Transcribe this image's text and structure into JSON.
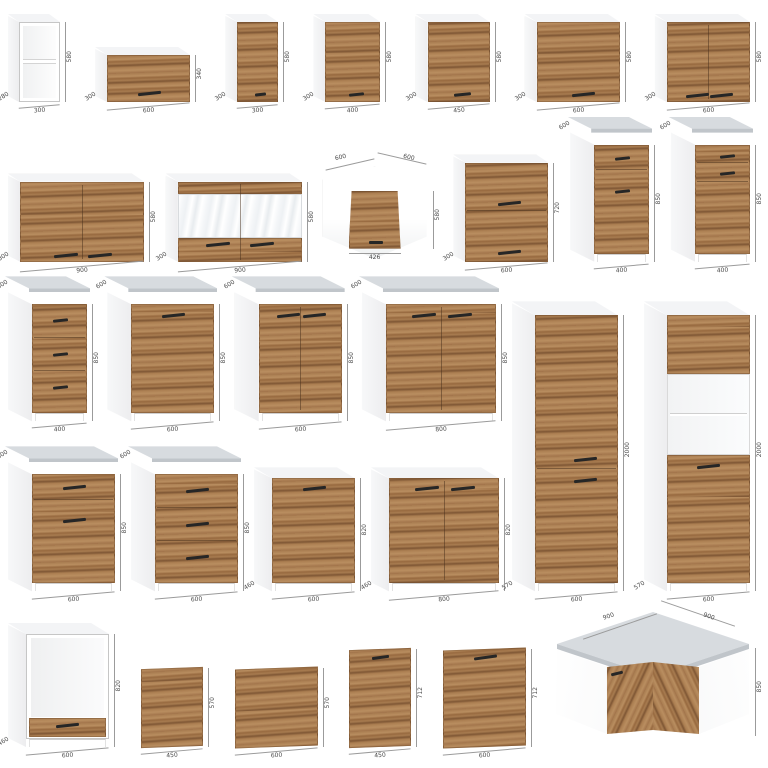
{
  "page": {
    "background": "#ffffff"
  },
  "colors": {
    "wood": "#a87c50",
    "wood_dark": "#7e5634",
    "wood_light": "#b98e60",
    "carcass": "#ffffff",
    "side_shade": "#ededef",
    "edge": "#c6c6c6",
    "worktop_top": "#d7dbdf",
    "worktop_edge": "#c0c5ca",
    "dim_line": "#9b9b9b",
    "dim_text": "#4a4a4a",
    "handle": "#262626",
    "glass": "#eef1f4",
    "niche": "#f4f5f6"
  },
  "rows": [
    [
      {
        "type": "wall-open",
        "name": "wall-open-shelf-300",
        "w": "300",
        "h": "580",
        "d": "280"
      },
      {
        "type": "wall-flap",
        "name": "wall-flap-cabinet-600",
        "w": "600",
        "h": "340",
        "d": "300"
      },
      {
        "type": "wall-door",
        "name": "wall-cabinet-300",
        "w": "300",
        "h": "580",
        "d": "300"
      },
      {
        "type": "wall-door",
        "name": "wall-cabinet-400",
        "w": "400",
        "h": "580",
        "d": "300"
      },
      {
        "type": "wall-door",
        "name": "wall-cabinet-450",
        "w": "450",
        "h": "580",
        "d": "300"
      },
      {
        "type": "wall-door",
        "name": "wall-cabinet-600",
        "w": "600",
        "h": "580",
        "d": "300"
      },
      {
        "type": "wall-2door",
        "name": "wall-cabinet-2door-600",
        "w": "600",
        "h": "580",
        "d": "300"
      }
    ],
    [
      {
        "type": "wall-2door",
        "name": "wall-cabinet-2door-900",
        "w": "900",
        "h": "580",
        "d": "300"
      },
      {
        "type": "wall-glass",
        "name": "wall-glass-cabinet-900",
        "w": "900",
        "h": "580",
        "d": "300"
      },
      {
        "type": "wall-corner",
        "name": "wall-corner-cabinet-600x600",
        "w1": "600",
        "w2": "600",
        "h": "580",
        "door": "426"
      },
      {
        "type": "wall-2flap",
        "name": "wall-2flap-cabinet-600",
        "w": "600",
        "h": "720",
        "d": "300"
      },
      {
        "type": "base-drawer-door",
        "name": "base-drawer-door-400",
        "w": "400",
        "h": "850",
        "d": "600"
      },
      {
        "type": "base-drawer-door2",
        "name": "base-2drawer-door-400",
        "w": "400",
        "h": "850",
        "d": "600"
      }
    ],
    [
      {
        "type": "base-3drawer",
        "name": "base-3drawer-400",
        "w": "400",
        "h": "850",
        "d": "600"
      },
      {
        "type": "base-door",
        "name": "base-door-600",
        "w": "600",
        "h": "850",
        "d": "600"
      },
      {
        "type": "base-2door",
        "name": "base-2door-600",
        "w": "600",
        "h": "850",
        "d": "600"
      },
      {
        "type": "base-2door",
        "name": "base-2door-800",
        "w": "800",
        "h": "850",
        "d": "600"
      }
    ],
    [
      {
        "type": "base-drawer-door",
        "name": "base-drawer-door-600",
        "w": "600",
        "h": "850",
        "d": "600"
      },
      {
        "type": "base-3drawer",
        "name": "base-3drawer-600",
        "w": "600",
        "h": "850",
        "d": "600"
      },
      {
        "type": "base-nt-door",
        "name": "base-sink-door-600",
        "w": "600",
        "h": "820",
        "d": "460"
      },
      {
        "type": "base-nt-2door",
        "name": "base-sink-2door-800",
        "w": "800",
        "h": "820",
        "d": "460"
      }
    ],
    [
      {
        "type": "tall-2door",
        "name": "tall-pantry-600",
        "w": "600",
        "h": "2000",
        "d": "570"
      },
      {
        "type": "tall-oven",
        "name": "tall-oven-housing-600",
        "w": "600",
        "h": "2000",
        "d": "570"
      }
    ],
    [
      {
        "type": "oven-base",
        "name": "oven-housing-base-600",
        "w": "600",
        "h": "820",
        "d": "460"
      },
      {
        "type": "panel",
        "name": "front-panel-450x570",
        "w": "450",
        "h": "570"
      },
      {
        "type": "panel",
        "name": "front-panel-600x570",
        "w": "600",
        "h": "570"
      },
      {
        "type": "panel-handle",
        "name": "front-panel-450x712",
        "w": "450",
        "h": "712"
      },
      {
        "type": "panel-handle",
        "name": "front-panel-600x712",
        "w": "600",
        "h": "712"
      },
      {
        "type": "base-corner",
        "name": "corner-base-cabinet-900x900",
        "w1": "900",
        "w2": "900",
        "h": "850"
      }
    ]
  ]
}
